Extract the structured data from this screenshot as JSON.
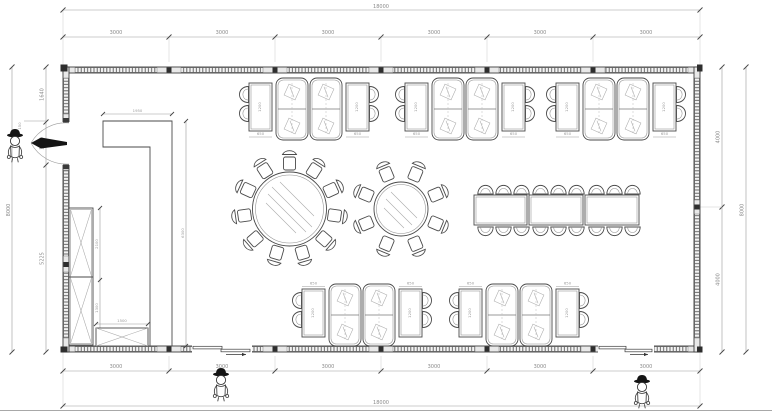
{
  "dims": {
    "overall_width": "18000",
    "overall_height": "8000",
    "top_bays": [
      "3000",
      "3000",
      "3000",
      "3000",
      "3000",
      "3000"
    ],
    "bottom_bays": [
      "3000",
      "3000",
      "3000",
      "3000",
      "3000",
      "3000"
    ],
    "left_segments": [
      "1640",
      "1135",
      "5225"
    ],
    "right_segments": [
      "4000",
      "4000"
    ],
    "door_offset": "150",
    "counter_width": "1950",
    "counter_length": "6300",
    "cabinet_upper": "2100",
    "cabinet_lower": "1300",
    "sideboard_width": "1500",
    "table_width": "650",
    "table_length": "1200"
  }
}
